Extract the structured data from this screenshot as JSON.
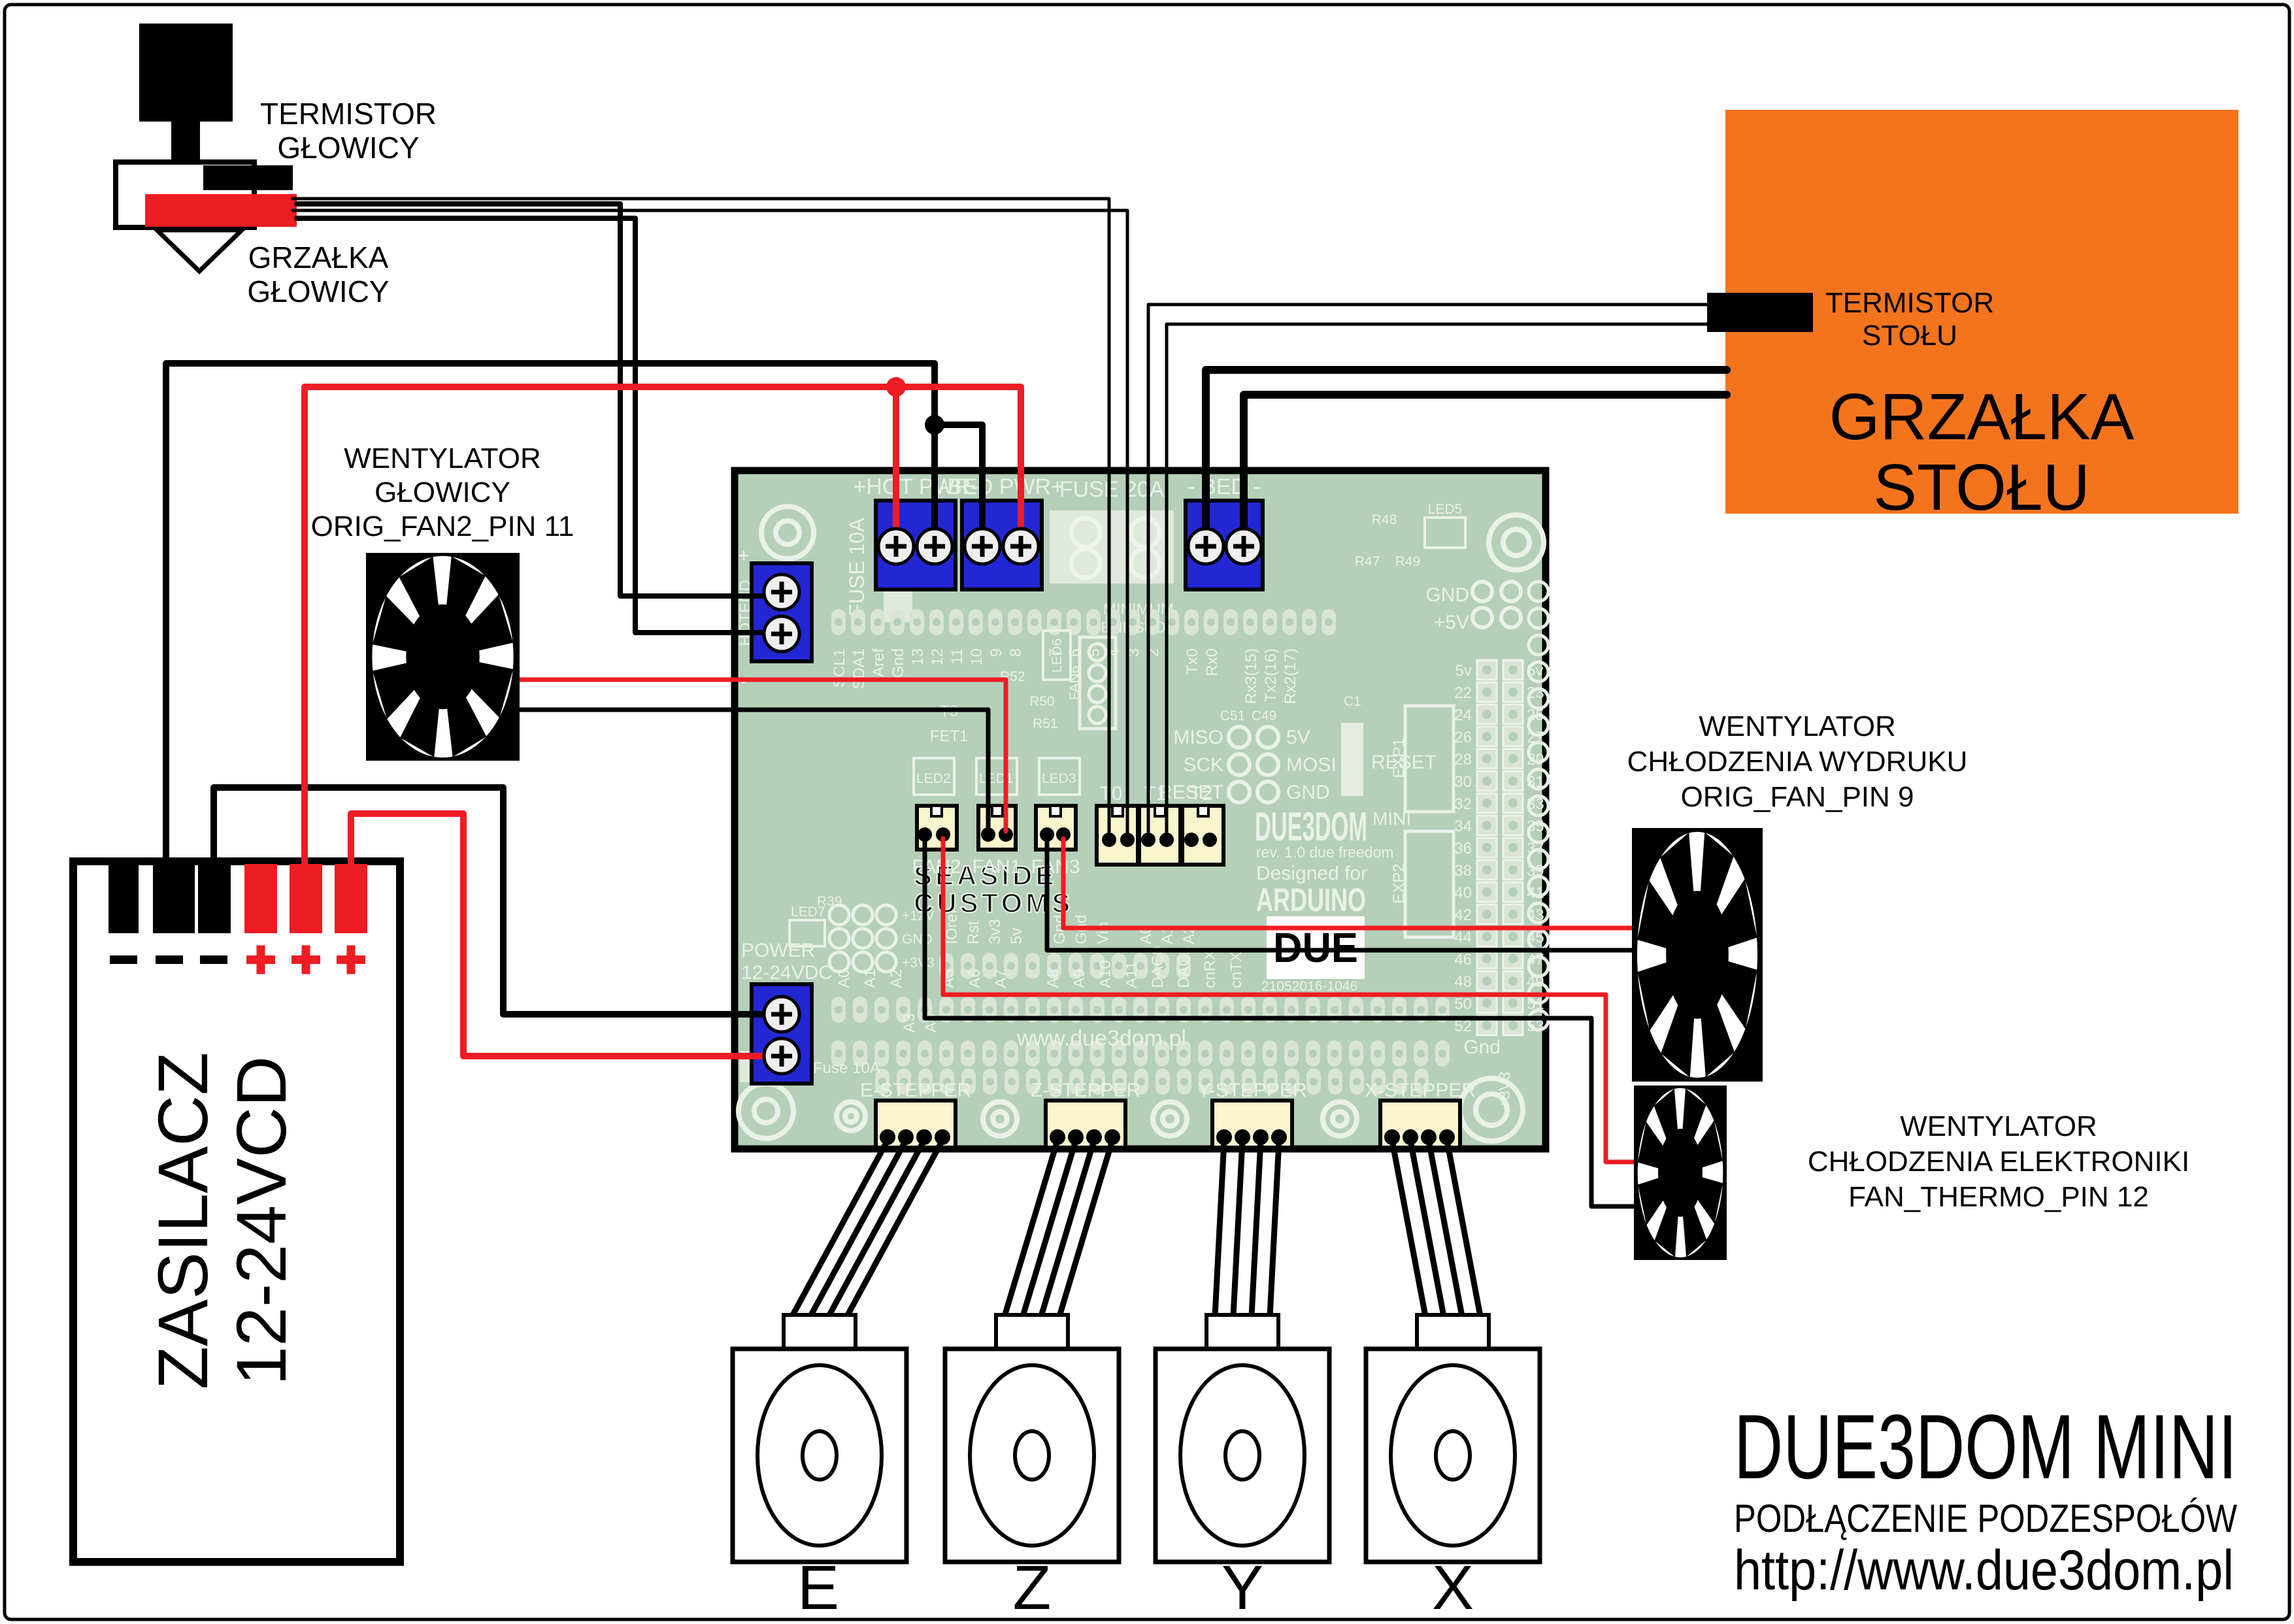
{
  "colors": {
    "wire_red": "#ee1c23",
    "terminal_blue": "#2327d3",
    "bed_orange": "#f4741e",
    "pcb_green": "#b5cfb8",
    "silk": "#e9f1e7",
    "connector_yellow": "#f9f5cd"
  },
  "hotend": {
    "thermistor_label": [
      "TERMISTOR",
      "GŁOWICY"
    ],
    "heater_label": [
      "GRZAŁKA",
      "GŁOWICY"
    ]
  },
  "bed": {
    "thermistor_label": [
      "TERMISTOR",
      "STOŁU"
    ],
    "heater_label": [
      "GRZAŁKA",
      "STOŁU"
    ]
  },
  "psu": {
    "line1": "ZASILACZ",
    "line2": "12-24VCD"
  },
  "fans": {
    "head": [
      "WENTYLATOR",
      "GŁOWICY",
      "ORIG_FAN2_PIN 11"
    ],
    "print": [
      "WENTYLATOR",
      "CHŁODZENIA WYDRUKU",
      "ORIG_FAN_PIN 9"
    ],
    "electronics": [
      "WENTYLATOR",
      "CHŁODZENIA ELEKTRONIKI",
      "FAN_THERMO_PIN 12"
    ]
  },
  "board": {
    "silk": {
      "hot_pwr": "+HOT PWR-",
      "bed_pwr": "-BED PWR+",
      "fuse20": "FUSE 20A",
      "bed_out": "- BED -",
      "fuse10_side": "FUSE 10A",
      "fuse10_small": "Fuse 10A",
      "hotend": "HOTEND",
      "plus": "+",
      "minus": "-",
      "power1": "POWER",
      "power2": "12-24VDC",
      "miso": "MISO",
      "sck": "SCK",
      "reset": "RESET",
      "v5": "5V",
      "mosi": "MOSI",
      "gnd": "GND",
      "reset_btn": "RESET",
      "c51": "C51",
      "c49": "C49",
      "c1": "C1",
      "due3dom": "DUE3DOM",
      "mini": "MINI",
      "rev": "rev. 1.0   due freedom",
      "designed": "Designed for",
      "arduino": "ARDUINO",
      "due": "DUE",
      "serial": "21052016-1046",
      "seaside1": "SEASIDE",
      "seaside2": "CUSTOMS",
      "url": "www.due3dom.pl",
      "gnd_cap": "GND",
      "p5v": "+5V",
      "gnd_low": "Gnd",
      "v33": "+3V3",
      "min1": "MINIMUM",
      "min2": "ENDSTOP",
      "exp1": "EXP1",
      "exp2": "EXP2",
      "fan1": "FAN1",
      "fan2": "FAN2",
      "fan3": "FAN3",
      "fan6": "FAN6",
      "t0": "T0",
      "t1": "T1",
      "t2": "T2",
      "t3": "T3",
      "fet1": "FET1",
      "led1": "LED1",
      "led2": "LED2",
      "led3": "LED3",
      "led5": "LED5",
      "led6": "LED6",
      "led7": "LED7",
      "r48": "R48",
      "r47": "R47",
      "r49": "R49",
      "r50": "R50",
      "r51": "R51",
      "r52": "R52",
      "r39": "R39",
      "p12v": "+12V",
      "gnd_g": "GND",
      "v33b": "+3V3"
    },
    "top_pins": [
      "SCL1",
      "SDA1",
      "Aref",
      "Gnd",
      "13",
      "12",
      "11",
      "10",
      "9",
      "8",
      "",
      "7",
      "6",
      "5",
      "4",
      "3",
      "2",
      "",
      "Tx0",
      "Rx0",
      "",
      "Rx3(15)",
      "Tx2(16)",
      "Rx2(17)"
    ],
    "right_pins": [
      [
        "5v",
        "5v"
      ],
      [
        "22",
        "23"
      ],
      [
        "24",
        "25"
      ],
      [
        "26",
        "27"
      ],
      [
        "28",
        "29"
      ],
      [
        "30",
        "31"
      ],
      [
        "32",
        "33"
      ],
      [
        "34",
        "35"
      ],
      [
        "36",
        "37"
      ],
      [
        "38",
        "39"
      ],
      [
        "40",
        "41"
      ],
      [
        "42",
        "43"
      ],
      [
        "44",
        "45"
      ],
      [
        "46",
        "47"
      ],
      [
        "48",
        "49"
      ],
      [
        "50",
        "51"
      ],
      [
        "52",
        "53"
      ]
    ],
    "power_row": [
      "IOref",
      "Rst",
      "3v3",
      "5v",
      "",
      "Gnd",
      "Gnd",
      "Vin",
      "",
      "A0",
      "A1",
      "A2"
    ],
    "analog_row": [
      "A0",
      "A1",
      "A2",
      "",
      "A5",
      "A6",
      "A7",
      "",
      "A8",
      "A9",
      "A10",
      "A11",
      "DAC0",
      "DAC1",
      "cnRX",
      "cnTX"
    ],
    "row_b": [
      "A3",
      "A4"
    ],
    "stepper_conns": [
      "E-STEPPER",
      "Z-STEPPER",
      "Y-STEPPER",
      "X-STEPPER"
    ]
  },
  "steppers": {
    "letters": [
      "E",
      "Z",
      "Y",
      "X"
    ]
  },
  "title": {
    "line1": "DUE3DOM MINI",
    "line2": "PODŁĄCZENIE PODZESPOŁÓW",
    "line3": "http://www.due3dom.pl"
  }
}
